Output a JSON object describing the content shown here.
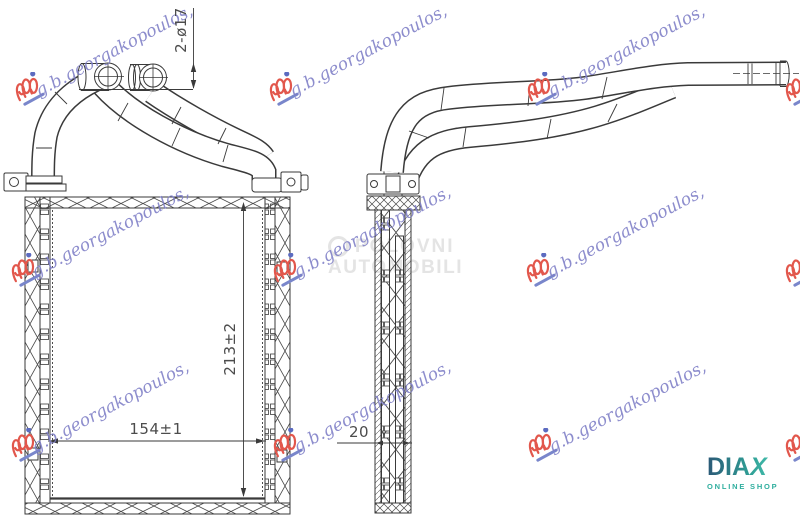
{
  "watermark": {
    "text": "g.b.georgakopoulos,"
  },
  "marketplace_watermark": {
    "line1": "POLOVNI",
    "line2": "AUTOMOBILI"
  },
  "dimensions": {
    "pipe_ports": "2-ø17",
    "core_height": "213±2",
    "core_width": "154±1",
    "core_depth": "20"
  },
  "retailer_logo": {
    "name_primary": "DIA",
    "name_accent": "X",
    "tagline": "ONLINE SHOP"
  },
  "colors": {
    "line": "#3a3a3a",
    "watermark_text": "#7d7dc6",
    "watermark_logo_red": "#e2574c",
    "watermark_logo_blue": "#5c6bc0",
    "marketplace_gray": "#e4e4e4",
    "diax_dark": "#2b5876",
    "diax_teal": "#4cc8b4"
  }
}
